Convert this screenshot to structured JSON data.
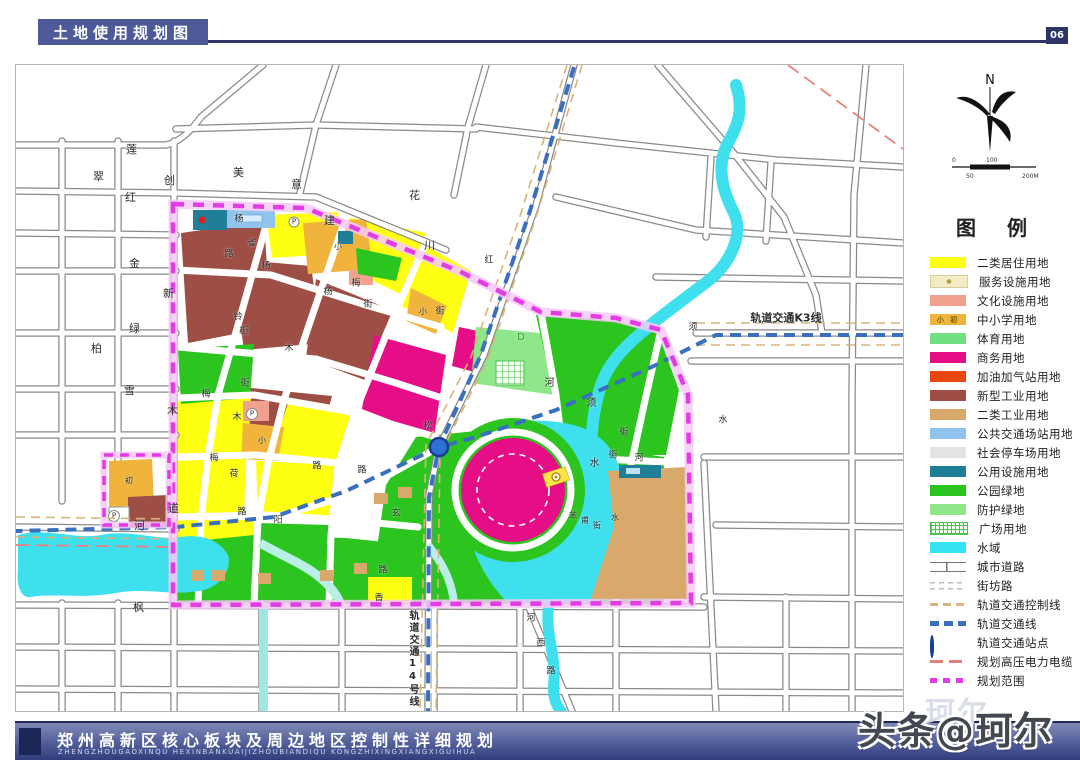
{
  "header": {
    "title": "土地使用规划图",
    "page": "06"
  },
  "compass": {
    "north": "N",
    "scale": {
      "zero": "0",
      "hundred": "100",
      "fifty": "50",
      "two_hundred": "200M"
    }
  },
  "legend": {
    "heading": "图 例",
    "items": [
      {
        "label": "二类居住用地",
        "swatch": "solid",
        "color": "#ffff12"
      },
      {
        "label": "服务设施用地",
        "swatch": "service",
        "color": "#f1ecc3"
      },
      {
        "label": "文化设施用地",
        "swatch": "solid",
        "color": "#f0a28e"
      },
      {
        "label": "中小学用地",
        "swatch": "school",
        "color": "#f0b43c",
        "mark": "小 初"
      },
      {
        "label": "体育用地",
        "swatch": "solid",
        "color": "#71e083"
      },
      {
        "label": "商务用地",
        "swatch": "solid",
        "color": "#e60e87"
      },
      {
        "label": "加油加气站用地",
        "swatch": "solid",
        "color": "#e8470f"
      },
      {
        "label": "新型工业用地",
        "swatch": "solid",
        "color": "#9e4f45"
      },
      {
        "label": "二类工业用地",
        "swatch": "solid",
        "color": "#d9a96b"
      },
      {
        "label": "公共交通场站用地",
        "swatch": "solid",
        "color": "#90c4ee"
      },
      {
        "label": "社会停车场用地",
        "swatch": "solid",
        "color": "#e3e3e3"
      },
      {
        "label": "公用设施用地",
        "swatch": "solid",
        "color": "#1f7f99"
      },
      {
        "label": "公园绿地",
        "swatch": "solid",
        "color": "#2cc41f"
      },
      {
        "label": "防护绿地",
        "swatch": "solid",
        "color": "#8fe789"
      },
      {
        "label": "广场用地",
        "swatch": "plaza",
        "color": "#4fbf4f"
      },
      {
        "label": "水域",
        "swatch": "solid",
        "color": "#35e3f2"
      },
      {
        "label": "城市道路",
        "swatch": "road",
        "color": "#777777"
      },
      {
        "label": "街坊路",
        "swatch": "lane",
        "color": "#bbbbbb"
      },
      {
        "label": "轨道交通控制线",
        "swatch": "dash",
        "color": "#d9b37c"
      },
      {
        "label": "轨道交通线",
        "swatch": "dash-bold",
        "color": "#3a6fc0"
      },
      {
        "label": "轨道交通站点",
        "swatch": "station",
        "color": "#2e6fd6"
      },
      {
        "label": "规划高压电力电缆",
        "swatch": "dash-long",
        "color": "#e0807d"
      },
      {
        "label": "规划范围",
        "swatch": "dash-sq",
        "color": "#e23ce2"
      }
    ]
  },
  "map": {
    "annotations": {
      "rail_k3": "轨道交通K3线",
      "rail_14": "轨道交通14号线"
    },
    "labels": [
      {
        "t": "莲",
        "x": 115,
        "y": 85,
        "v": 1
      },
      {
        "t": "翠",
        "x": 82,
        "y": 112,
        "v": 1
      },
      {
        "t": "红",
        "x": 114,
        "y": 133,
        "v": 1
      },
      {
        "t": "创",
        "x": 153,
        "y": 116,
        "v": 1
      },
      {
        "t": "美",
        "x": 222,
        "y": 108,
        "v": 1
      },
      {
        "t": "意",
        "x": 280,
        "y": 120,
        "v": 1
      },
      {
        "t": "花",
        "x": 398,
        "y": 131,
        "v": 1
      },
      {
        "t": "建",
        "x": 313,
        "y": 156,
        "v": 1
      },
      {
        "t": "川",
        "x": 413,
        "y": 181,
        "v": 1
      },
      {
        "t": "金",
        "x": 118,
        "y": 199,
        "v": 1
      },
      {
        "t": "新",
        "x": 152,
        "y": 229,
        "v": 1
      },
      {
        "t": "绿",
        "x": 118,
        "y": 264,
        "v": 1
      },
      {
        "t": "柏",
        "x": 80,
        "y": 284,
        "v": 1
      },
      {
        "t": "雪",
        "x": 113,
        "y": 326,
        "v": 1
      },
      {
        "t": "木",
        "x": 156,
        "y": 346,
        "v": 1
      },
      {
        "t": "道",
        "x": 157,
        "y": 444,
        "v": 1
      },
      {
        "t": "河",
        "x": 123,
        "y": 461,
        "v": 1
      },
      {
        "t": "枫",
        "x": 122,
        "y": 543,
        "v": 1
      },
      {
        "t": "杨",
        "x": 223,
        "y": 155,
        "s": 9
      },
      {
        "t": "雀",
        "x": 236,
        "y": 179,
        "s": 9
      },
      {
        "t": "路",
        "x": 213,
        "y": 190,
        "s": 9
      },
      {
        "t": "杨",
        "x": 250,
        "y": 202,
        "s": 9
      },
      {
        "t": "杨",
        "x": 312,
        "y": 228,
        "s": 9
      },
      {
        "t": "街",
        "x": 424,
        "y": 247,
        "s": 9
      },
      {
        "t": "铃",
        "x": 222,
        "y": 253,
        "s": 9
      },
      {
        "t": "街",
        "x": 228,
        "y": 267,
        "s": 9
      },
      {
        "t": "木",
        "x": 273,
        "y": 284,
        "s": 9
      },
      {
        "t": "梅",
        "x": 340,
        "y": 219,
        "s": 9
      },
      {
        "t": "街",
        "x": 352,
        "y": 240,
        "s": 9
      },
      {
        "t": "街",
        "x": 229,
        "y": 319,
        "s": 9
      },
      {
        "t": "木",
        "x": 221,
        "y": 353,
        "s": 9
      },
      {
        "t": "梅",
        "x": 190,
        "y": 330,
        "s": 9
      },
      {
        "t": "梅",
        "x": 198,
        "y": 394,
        "s": 9
      },
      {
        "t": "荷",
        "x": 218,
        "y": 410,
        "s": 9
      },
      {
        "t": "路",
        "x": 226,
        "y": 448,
        "s": 9
      },
      {
        "t": "阳",
        "x": 262,
        "y": 456,
        "s": 9
      },
      {
        "t": "路",
        "x": 301,
        "y": 402,
        "s": 9
      },
      {
        "t": "路",
        "x": 346,
        "y": 406,
        "s": 9
      },
      {
        "t": "玄",
        "x": 380,
        "y": 449,
        "s": 9
      },
      {
        "t": "松",
        "x": 412,
        "y": 362,
        "s": 9
      },
      {
        "t": "红",
        "x": 473,
        "y": 196,
        "s": 9
      },
      {
        "t": "香",
        "x": 363,
        "y": 534,
        "s": 9
      },
      {
        "t": "路",
        "x": 367,
        "y": 506,
        "s": 9
      },
      {
        "t": "苯",
        "x": 557,
        "y": 451,
        "s": 8
      },
      {
        "t": "甫",
        "x": 569,
        "y": 456,
        "s": 8
      },
      {
        "t": "街",
        "x": 581,
        "y": 461,
        "s": 8
      },
      {
        "t": "水",
        "x": 599,
        "y": 453,
        "s": 8
      },
      {
        "t": "河",
        "x": 531,
        "y": 318,
        "s": 10,
        "v": 1
      },
      {
        "t": "须",
        "x": 573,
        "y": 338,
        "s": 10,
        "v": 1
      },
      {
        "t": "水",
        "x": 576,
        "y": 398,
        "s": 10,
        "v": 1
      },
      {
        "t": "街",
        "x": 597,
        "y": 391,
        "s": 9
      },
      {
        "t": "河",
        "x": 623,
        "y": 394,
        "s": 9
      },
      {
        "t": "街",
        "x": 608,
        "y": 368,
        "s": 9
      },
      {
        "t": "须",
        "x": 675,
        "y": 262,
        "s": 9,
        "v": 1
      },
      {
        "t": "水",
        "x": 705,
        "y": 355,
        "s": 9,
        "v": 1
      },
      {
        "t": "河",
        "x": 513,
        "y": 553,
        "s": 9,
        "v": 1
      },
      {
        "t": "西",
        "x": 523,
        "y": 578,
        "s": 9,
        "v": 1
      },
      {
        "t": "路",
        "x": 533,
        "y": 606,
        "s": 9,
        "v": 1
      },
      {
        "t": "D",
        "x": 505,
        "y": 273,
        "s": 10,
        "c": "#2f9e2f"
      },
      {
        "t": "小",
        "x": 322,
        "y": 182,
        "s": 8
      },
      {
        "t": "小",
        "x": 407,
        "y": 247,
        "s": 8
      },
      {
        "t": "小",
        "x": 246,
        "y": 376,
        "s": 8
      },
      {
        "t": "初",
        "x": 113,
        "y": 416,
        "s": 8
      },
      {
        "t": "P",
        "x": 236,
        "y": 349,
        "s": 7
      },
      {
        "t": "P",
        "x": 98,
        "y": 451,
        "s": 7
      },
      {
        "t": "P",
        "x": 278,
        "y": 157,
        "s": 7
      },
      {
        "t": "轨道交通K3线",
        "x": 770,
        "y": 253,
        "s": 11,
        "b": 1
      },
      {
        "t": "轨道交通14号线",
        "x": 396,
        "y": 594,
        "v": 1,
        "s": 10,
        "b": 1
      }
    ]
  },
  "footer": {
    "title": "郑州高新区核心板块及周边地区控制性详细规划",
    "pinyin": "ZHENGZHOUGAOXINQU  HEXINBANKUAIJIZHOUBIANDIQU  KONGZHIXINGXIANGXIGUIHUA"
  },
  "watermark": {
    "text": "头条@珂尔",
    "ghost": "珂尔"
  },
  "colors": {
    "header_bar": "#4d5a99",
    "header_line": "#2c3566",
    "footer_dark": "#303d7d",
    "boundary": "#e23ce2",
    "rail": "#3a6fc0",
    "rail_control": "#d9b37c",
    "power": "#e0807d",
    "water": "#35e3f2",
    "park": "#2cc41f"
  }
}
